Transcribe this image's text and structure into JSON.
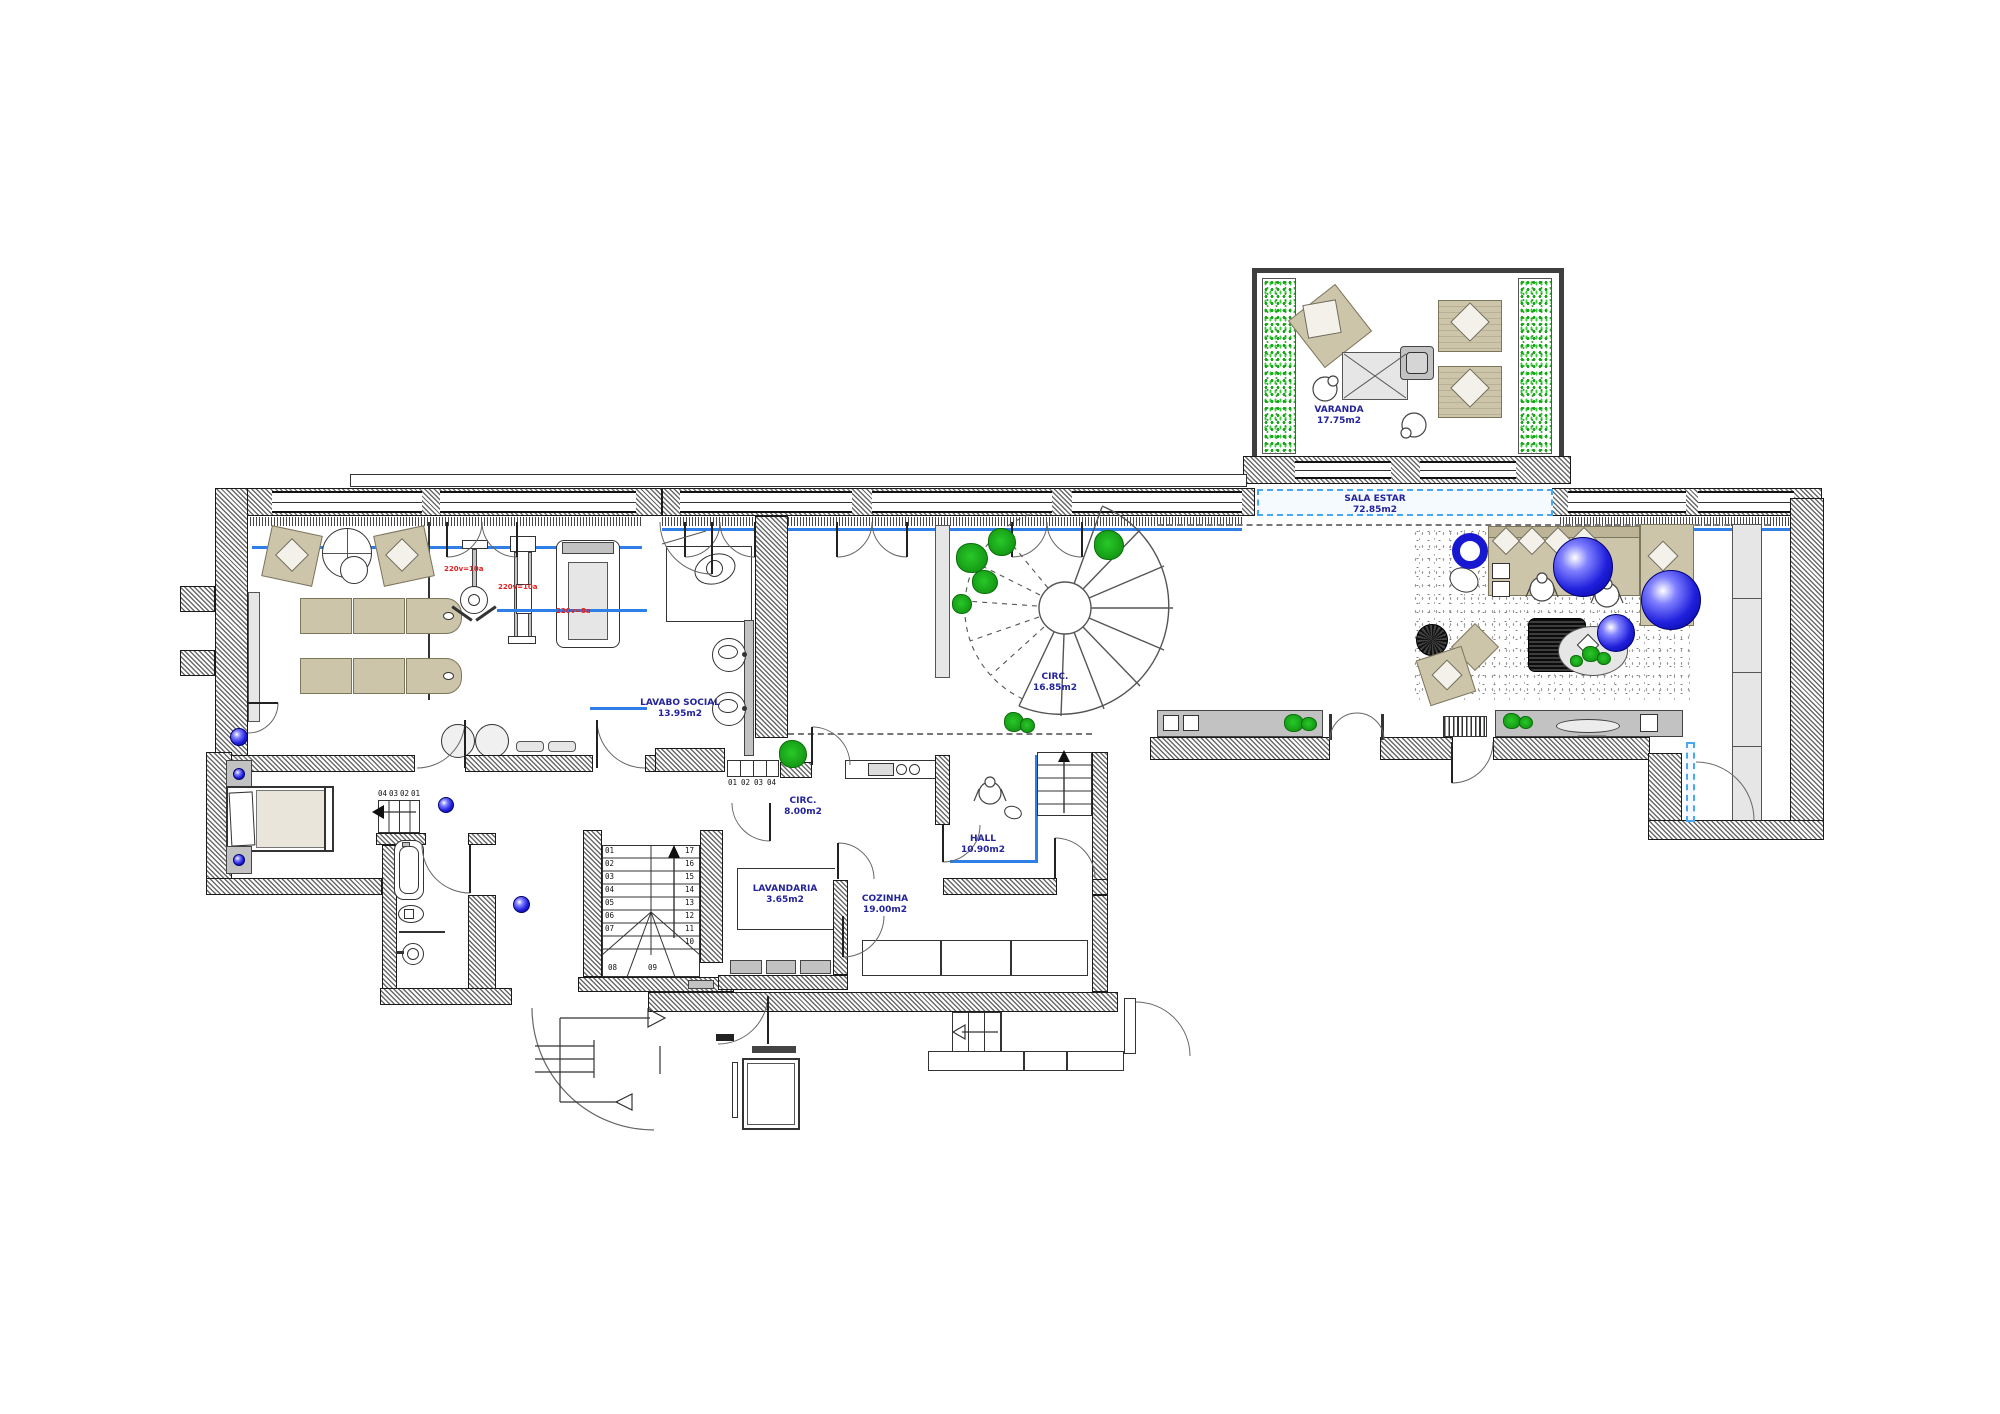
{
  "rooms": {
    "varanda": {
      "name": "VARANDA",
      "area": "17.75m2"
    },
    "sala_estar": {
      "name": "SALA ESTAR",
      "area": "72.85m2"
    },
    "circ_spiral": {
      "name": "CIRC.",
      "area": "16.85m2"
    },
    "lavabo_social": {
      "name": "LAVABO SOCIAL",
      "area": "13.95m2"
    },
    "circ_hall": {
      "name": "CIRC.",
      "area": "8.00m2"
    },
    "hall": {
      "name": "HALL",
      "area": "10.90m2"
    },
    "lavandaria": {
      "name": "LAVANDARIA",
      "area": "3.65m2"
    },
    "cozinha": {
      "name": "COZINHA",
      "area": "19.00m2"
    }
  },
  "stairs": {
    "main": {
      "left": [
        "01",
        "02",
        "03",
        "04",
        "05",
        "06",
        "07"
      ],
      "right": [
        "17",
        "16",
        "15",
        "14",
        "13",
        "12",
        "11",
        "10"
      ],
      "bottom": [
        "08",
        "09"
      ]
    },
    "lavabo_steps": [
      "01",
      "02",
      "03",
      "04"
    ],
    "bedroom_steps": [
      "04",
      "03",
      "02",
      "01"
    ]
  },
  "equipment": {
    "gym_labels": [
      "220v=10a",
      "220v=10a",
      "220v=8a"
    ]
  },
  "colors": {
    "label_navy": "#23239b",
    "line_blue": "#2e7fe8",
    "plant_green": "#18a818",
    "sphere_blue": "#2020dd",
    "wall_gray": "#666666",
    "red_note": "#e02020"
  }
}
